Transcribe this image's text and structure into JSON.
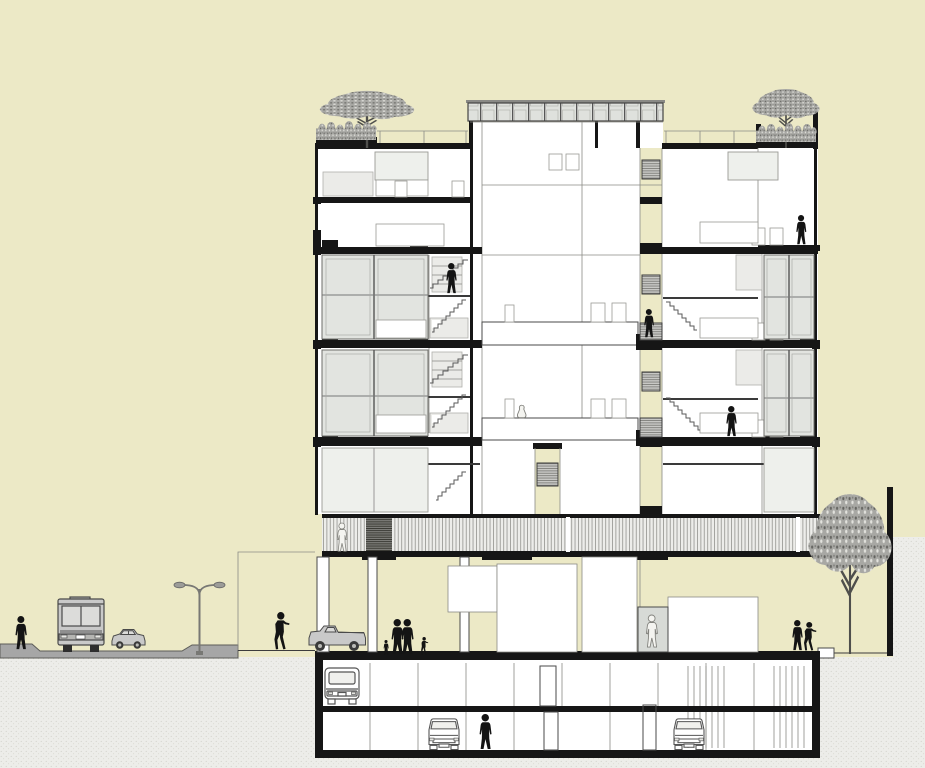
{
  "meta": {
    "description": "Architectural cross-section drawing of a multi-storey residential building with two basement parking levels, an open ground floor on pilotis, a slatted walkway deck, duplex apartments, roof gardens with trees, and a street scene with bus, cars, street lamp and pedestrians",
    "drawing_type": "building-section"
  },
  "palette": {
    "bg": "#ece9c6",
    "ink": "#161616",
    "glass": "#e2e4e0",
    "soil": "#ededE9",
    "road": "#a6a6a6",
    "vehicle": "#c9c9c9",
    "tree": "#a8a8a4"
  },
  "building": {
    "levels_above_ground": 7,
    "basement_levels": 2,
    "features": [
      "roof garden with trees",
      "glazed clerestory rooftop band",
      "duplex apartments with internal stairs",
      "central light well with vent grilles",
      "full-width slatted walkway deck",
      "open ground floor on pilotis",
      "glazed entrance lobby",
      "two-level underground parking"
    ]
  },
  "street": {
    "elements": [
      "sidewalk",
      "roadway with kerbs",
      "street lamp with double arm",
      "city bus (rear view)",
      "parked car",
      "pickup truck",
      "boundary wall",
      "street tree"
    ]
  },
  "scene": {
    "figures": [
      {
        "name": "pedestrian-sidewalk-left",
        "type": "person",
        "x": 14,
        "y": 616,
        "h": 34
      },
      {
        "name": "city-bus-rear",
        "type": "bus-rear",
        "x": 56,
        "y": 597,
        "w": 52,
        "h": 56
      },
      {
        "name": "car-on-road",
        "type": "car-side",
        "x": 110,
        "y": 628,
        "w": 37,
        "h": 22
      },
      {
        "name": "street-lamp",
        "type": "lamp",
        "x": 165,
        "y": 577,
        "w": 70,
        "h": 80
      },
      {
        "name": "pedestrian-near-building",
        "type": "person-walk",
        "x": 272,
        "y": 612,
        "w": 17,
        "h": 38
      },
      {
        "name": "pickup-truck",
        "type": "pickup-side",
        "x": 306,
        "y": 624,
        "w": 62,
        "h": 28
      },
      {
        "name": "family-child-1",
        "type": "person",
        "x": 383,
        "y": 640,
        "h": 15
      },
      {
        "name": "family-adult-1",
        "type": "person",
        "x": 390,
        "y": 619,
        "h": 36
      },
      {
        "name": "family-adult-2",
        "type": "person",
        "x": 400,
        "y": 619,
        "h": 36
      },
      {
        "name": "family-child-2",
        "type": "person-walk",
        "x": 420,
        "y": 637,
        "w": 8,
        "h": 18
      },
      {
        "name": "lobby-person",
        "type": "person-light",
        "x": 645,
        "y": 615,
        "h": 33,
        "tone": "light"
      },
      {
        "name": "resident-right-1",
        "type": "person",
        "x": 791,
        "y": 620,
        "h": 31
      },
      {
        "name": "resident-right-2",
        "type": "person-walk",
        "x": 802,
        "y": 622,
        "w": 14,
        "h": 29
      },
      {
        "name": "terrace-person",
        "type": "person",
        "x": 795,
        "y": 215,
        "h": 30
      },
      {
        "name": "stair-person",
        "type": "person",
        "x": 445,
        "y": 263,
        "h": 31
      },
      {
        "name": "lightwell-balcony-person",
        "type": "person",
        "x": 643,
        "y": 309,
        "h": 29
      },
      {
        "name": "apartment-person",
        "type": "person",
        "x": 725,
        "y": 406,
        "h": 31
      },
      {
        "name": "walkway-person",
        "type": "person-light",
        "x": 336,
        "y": 523,
        "h": 29,
        "tone": "light"
      },
      {
        "name": "basement-person",
        "type": "person",
        "x": 478,
        "y": 714,
        "h": 36
      },
      {
        "name": "pet-figure",
        "type": "blob",
        "x": 516,
        "y": 404,
        "h": 14,
        "tone": "light"
      },
      {
        "name": "parked-car-basement1",
        "type": "car-rear",
        "x": 322,
        "y": 666,
        "w": 40,
        "h": 40
      },
      {
        "name": "parked-car-basement2-left",
        "type": "car-front",
        "x": 425,
        "y": 717,
        "w": 38,
        "h": 33
      },
      {
        "name": "parked-car-basement2-right",
        "type": "car-front",
        "x": 670,
        "y": 717,
        "w": 38,
        "h": 33
      },
      {
        "name": "roof-tree-left",
        "type": "tree",
        "x": 308,
        "y": 88,
        "w": 118,
        "h": 60
      },
      {
        "name": "roof-shrubs-left",
        "type": "shrubs",
        "x": 316,
        "y": 122,
        "w": 60,
        "h": 18
      },
      {
        "name": "roof-tree-right",
        "type": "tree",
        "x": 744,
        "y": 86,
        "w": 84,
        "h": 62
      },
      {
        "name": "roof-shrubs-right",
        "type": "shrubs",
        "x": 756,
        "y": 124,
        "w": 60,
        "h": 18
      },
      {
        "name": "street-tree",
        "type": "tree",
        "x": 798,
        "y": 486,
        "w": 104,
        "h": 168
      }
    ]
  }
}
